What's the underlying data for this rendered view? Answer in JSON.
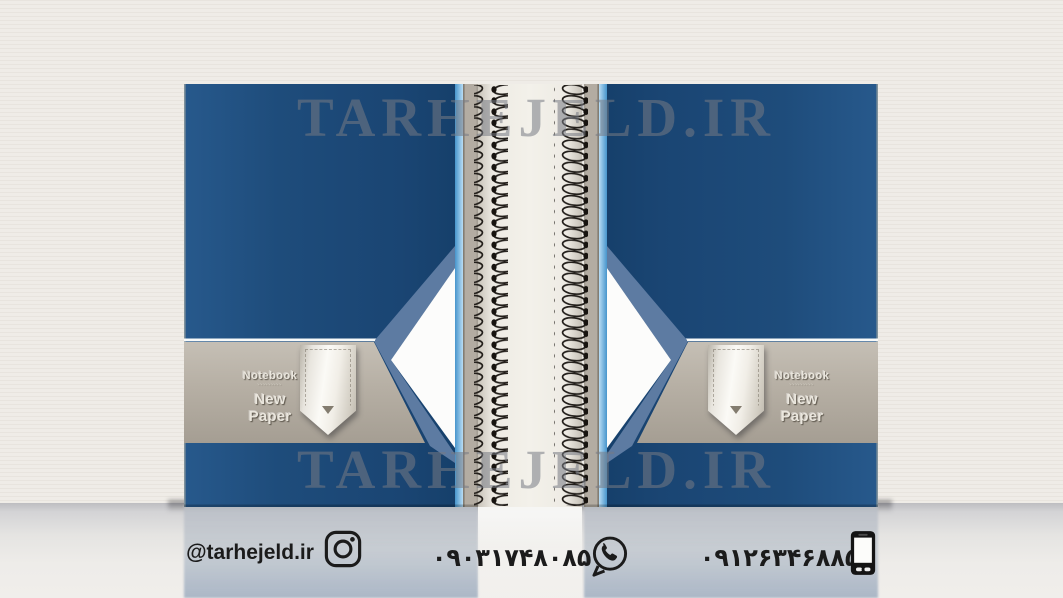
{
  "scene": {
    "watermark_text": "TARHEJELD.IR"
  },
  "covers": {
    "back": {
      "title": "Notebook",
      "fine_print": "·········",
      "subtitle": "New Paper"
    },
    "front": {
      "title": "Notebook",
      "fine_print": "·········",
      "subtitle": "New Paper"
    }
  },
  "contact": {
    "instagram_handle": "@tarhejeld.ir",
    "mobile_number_primary": "۰۹۰۳۱۷۴۸۰۸۵",
    "mobile_number_secondary": "۰۹۱۲۶۳۴۶۸۸۵",
    "icons": {
      "instagram": "instagram-outline",
      "whatsapp": "whatsapp-outline",
      "phone": "smartphone"
    }
  },
  "colors": {
    "cover_blue": "#1e4b7a",
    "accent_light_blue": "#6fb0dd",
    "band_tan": "#b5aea3",
    "slate_stripe": "#5d7ba2",
    "triangle_white": "#fcfcfb",
    "spine_paper": "#efece5",
    "wall": "#efece7",
    "watermark_gray": "#767a83",
    "contact_text": "#1b1b1b"
  }
}
